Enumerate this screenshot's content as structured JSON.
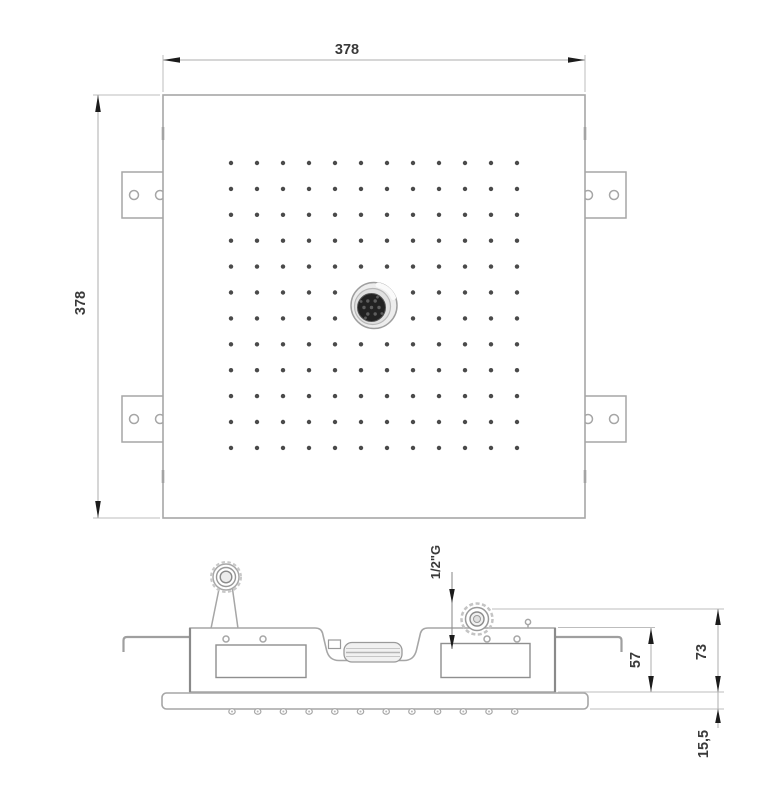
{
  "drawing_type": "technical-drawing-shower-head",
  "views": {
    "top": {
      "name": "top-view",
      "dim_width": "378",
      "dim_height": "378",
      "nozzle_grid": {
        "rows": 12,
        "cols": 12,
        "x0": 231,
        "y0": 163,
        "dx": 26,
        "dy": 25.9,
        "dot_radius": 2.2,
        "skip": [
          [
            5,
            5
          ],
          [
            6,
            5
          ],
          [
            5,
            6
          ],
          [
            6,
            6
          ]
        ]
      },
      "mounting_brackets": 4,
      "holes_per_bracket": 2
    },
    "side": {
      "name": "side-view",
      "dim_body_height": "57",
      "dim_total_height": "73",
      "dim_plate_height": "15,5",
      "thread_label": "1/2\"G",
      "plate_nozzles": {
        "count": 12,
        "x0": 232,
        "dx": 25.7,
        "y": 711.5
      }
    }
  },
  "colors": {
    "background": "#ffffff",
    "geometry_line": "#a6a6a6",
    "detail_line": "#8f8f8f",
    "dimension_line": "#adadad",
    "arrow_and_text": "#1c1c1c",
    "nozzle_dot": "#4a4a4a",
    "sprayer_dark": "#222222"
  }
}
